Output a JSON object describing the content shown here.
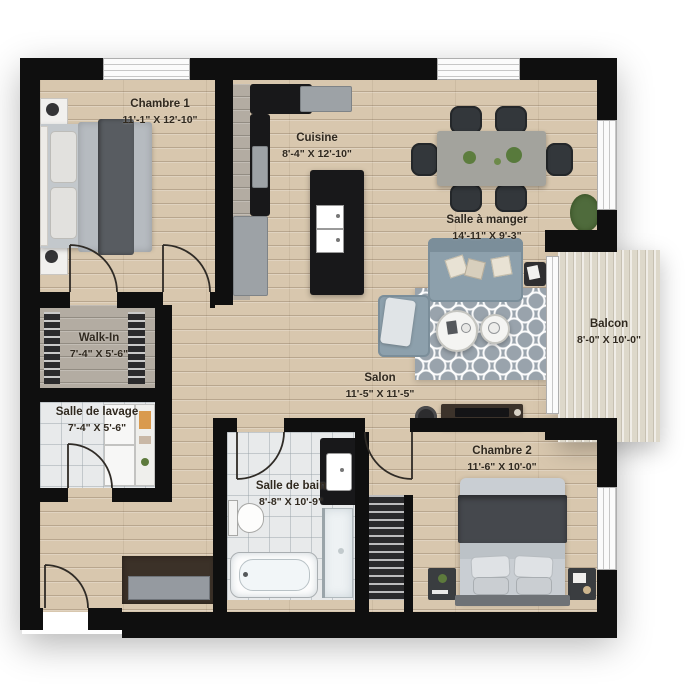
{
  "plan": {
    "title": "Apartment floor plan",
    "rooms": {
      "chambre1": {
        "name": "Chambre 1",
        "dims": "11'-1\" X 12'-10\""
      },
      "cuisine": {
        "name": "Cuisine",
        "dims": "8'-4\" X 12'-10\""
      },
      "salle_a_manger": {
        "name": "Salle à manger",
        "dims": "14'-11\" X 9'-3\""
      },
      "walk_in": {
        "name": "Walk-In",
        "dims": "7'-4\" X 5'-6\""
      },
      "salle_de_lavage": {
        "name": "Salle de lavage",
        "dims": "7'-4\" X 5'-6\""
      },
      "salon": {
        "name": "Salon",
        "dims": "11'-5\" X 11'-5\""
      },
      "balcon": {
        "name": "Balcon",
        "dims": "8'-0\" X 10'-0\""
      },
      "salle_de_bain": {
        "name": "Salle de bain",
        "dims": "8'-8\" X 10'-9\""
      },
      "chambre2": {
        "name": "Chambre 2",
        "dims": "11'-6\" X 10'-0\""
      }
    },
    "colors": {
      "wall": "#0f0f0f",
      "wood_floor": "#d8c7ae",
      "gray_wood": "#b3aca2",
      "tile": "#e8eaeb",
      "deck": "#ddd8ca",
      "rug": "#99a3ac",
      "counter": "#18181a",
      "sofa": "#8da0ac",
      "label_text": "#30291f"
    }
  }
}
